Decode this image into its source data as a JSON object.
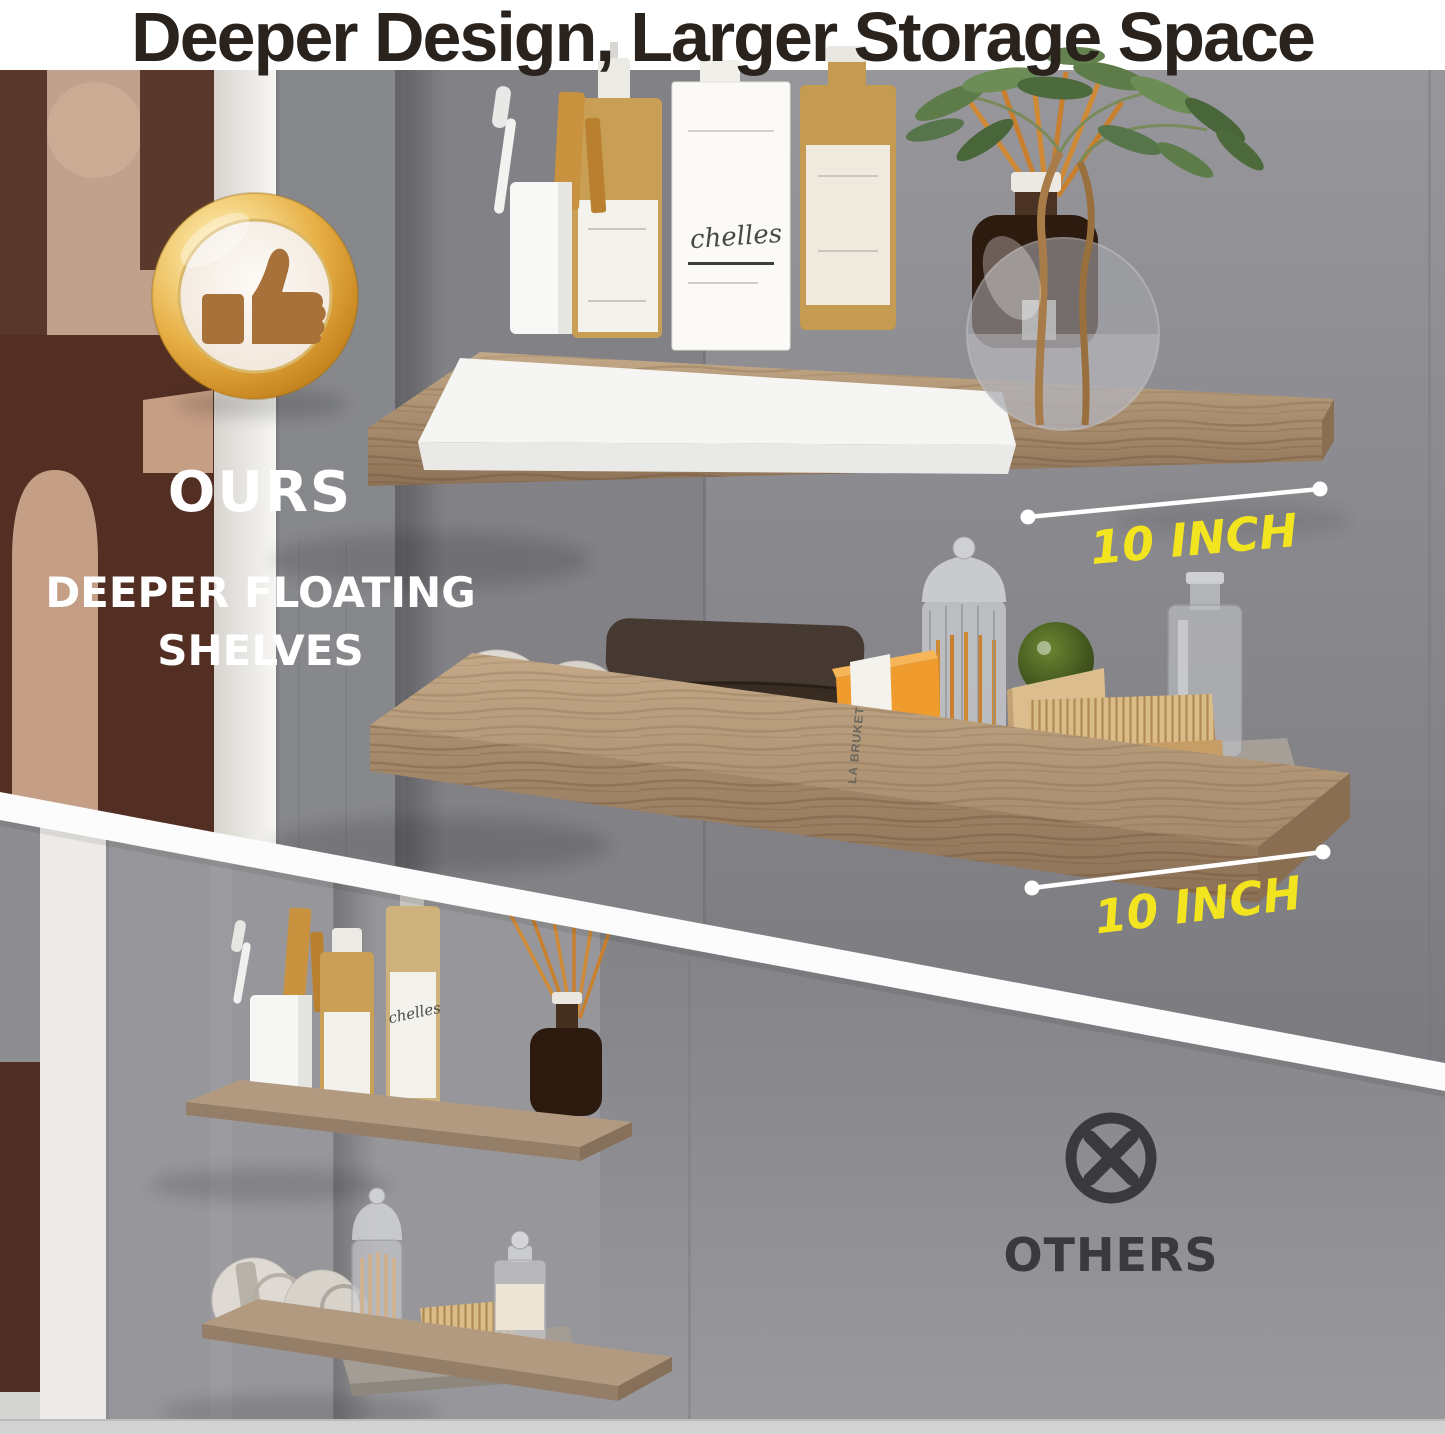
{
  "header": {
    "title": "Deeper Design, Larger Storage Space"
  },
  "ours_section": {
    "badge_icon": "thumbs-up-medal-icon",
    "label": "OURS",
    "subtitle": "DEEPER FLOATING SHELVES",
    "shelf_top_dimension": "10 INCH",
    "shelf_bottom_dimension": "10 INCH"
  },
  "others_section": {
    "icon": "x-circle-icon",
    "label": "OTHERS"
  },
  "photo_text": {
    "soap_box_brand": "LA BRUKET",
    "bottle_script": "chelles"
  },
  "colors": {
    "headline_text": "#2a221c",
    "dimension_yellow": "#f2e41e",
    "badge_gold": "#e0a93e",
    "others_icon_gray": "#3a393c",
    "wall_gray": "#87888c",
    "wood_tan": "#ab8f70",
    "divider_white": "#fcfcfc"
  }
}
